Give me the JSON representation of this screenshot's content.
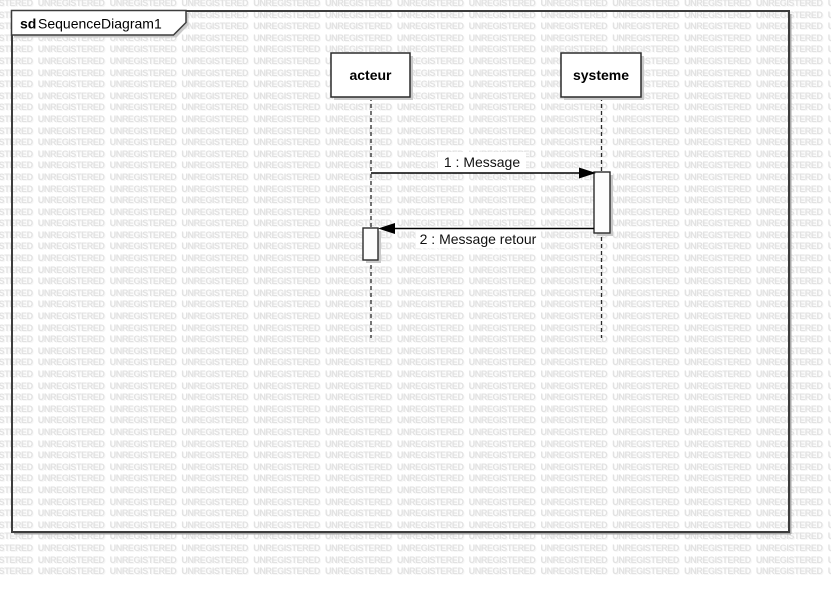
{
  "watermark": {
    "text": "UNREGISTERED",
    "color": "#e2e2e2",
    "rows": 50,
    "cols": 14
  },
  "frame": {
    "keyword": "sd",
    "title": "SequenceDiagram1"
  },
  "lifelines": [
    {
      "name": "acteur"
    },
    {
      "name": "systeme"
    }
  ],
  "messages": [
    {
      "label": "1 : Message",
      "from": "acteur",
      "to": "systeme",
      "type": "call"
    },
    {
      "label": "2 : Message retour",
      "from": "systeme",
      "to": "acteur",
      "type": "return"
    }
  ],
  "colors": {
    "frame_stroke": "#3d3d3d",
    "shape_stroke": "#2b2b2b",
    "shadow": "#c9c9c9",
    "frame_shadow": "#a8a8a8",
    "fill": "#ffffff",
    "watermark": "#e2e2e2",
    "text": "#000000"
  }
}
